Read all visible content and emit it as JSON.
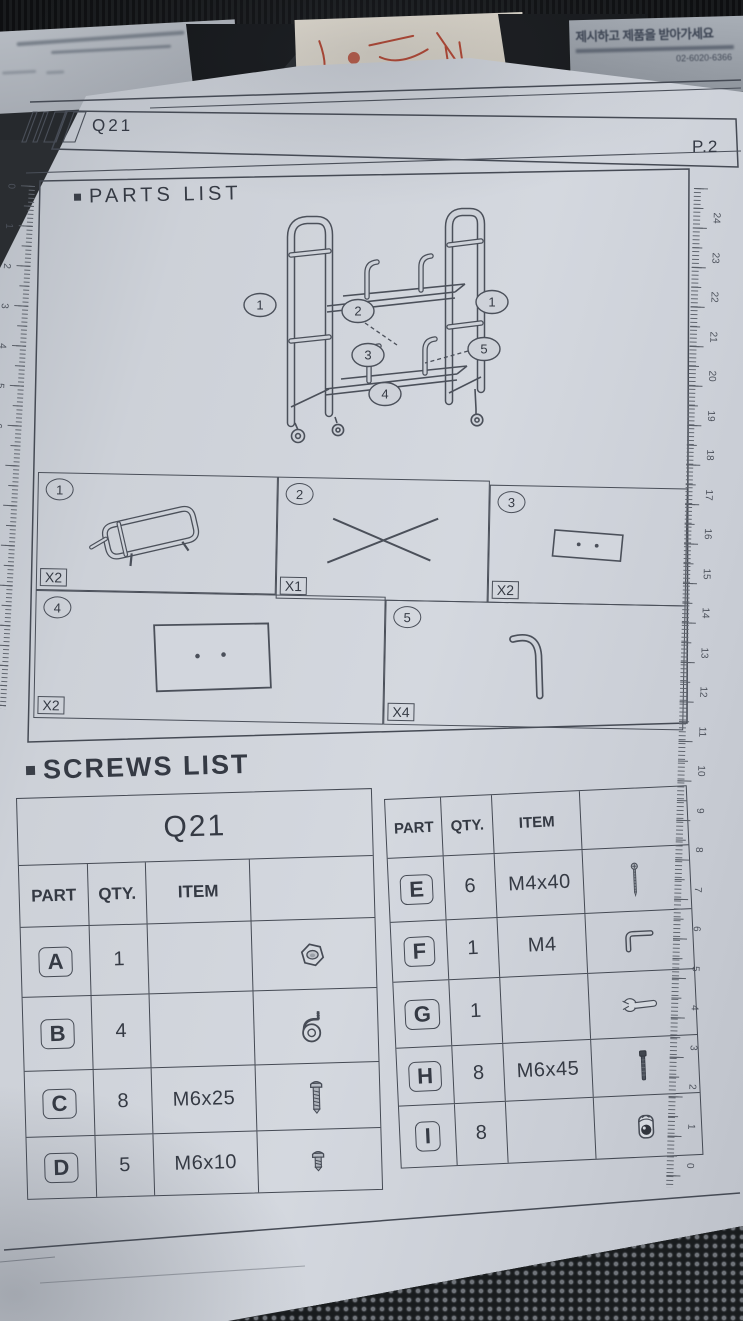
{
  "background": {
    "receipt_korean_line": "제시하고 제품을 받아가세요",
    "receipt_phone": "02-6020-6366"
  },
  "header": {
    "model": "Q21",
    "page": "P.2"
  },
  "parts_section": {
    "title": "PARTS LIST",
    "diagram_callouts": [
      "1",
      "2",
      "1",
      "3",
      "5",
      "4"
    ],
    "grid": [
      {
        "num": "1",
        "qty": "X2",
        "icon": "part-frame"
      },
      {
        "num": "2",
        "qty": "X1",
        "icon": "part-cross"
      },
      {
        "num": "3",
        "qty": "X2",
        "icon": "part-board-small"
      },
      {
        "num": "4",
        "qty": "X2",
        "icon": "part-board"
      },
      {
        "num": "5",
        "qty": "X4",
        "icon": "part-hook"
      }
    ]
  },
  "screws_section": {
    "title": "SCREWS LIST",
    "left_table": {
      "title": "Q21",
      "columns": [
        "PART",
        "QTY.",
        "ITEM",
        ""
      ],
      "rows": [
        {
          "part": "A",
          "qty": "1",
          "item": "",
          "icon": "hex-nut"
        },
        {
          "part": "B",
          "qty": "4",
          "item": "",
          "icon": "caster"
        },
        {
          "part": "C",
          "qty": "8",
          "item": "M6x25",
          "icon": "screw-long"
        },
        {
          "part": "D",
          "qty": "5",
          "item": "M6x10",
          "icon": "screw-short"
        }
      ]
    },
    "right_table": {
      "columns": [
        "PART",
        "QTY.",
        "ITEM",
        ""
      ],
      "rows": [
        {
          "part": "E",
          "qty": "6",
          "item": "M4x40",
          "icon": "screw-thin"
        },
        {
          "part": "F",
          "qty": "1",
          "item": "M4",
          "icon": "allen-key"
        },
        {
          "part": "G",
          "qty": "1",
          "item": "",
          "icon": "wrench"
        },
        {
          "part": "H",
          "qty": "8",
          "item": "M6x45",
          "icon": "bolt-dark"
        },
        {
          "part": "I",
          "qty": "8",
          "item": "",
          "icon": "barrel-nut"
        }
      ]
    }
  },
  "rulers": {
    "right_numbers": [
      24,
      23,
      22,
      21,
      20,
      19,
      18,
      17,
      16,
      15,
      14,
      13,
      12,
      11,
      10,
      9,
      8,
      7,
      6,
      5,
      4,
      3,
      2,
      1,
      0
    ],
    "left_numbers": [
      0,
      1,
      2,
      3,
      4,
      5,
      6,
      7,
      8,
      9,
      10,
      11,
      12
    ]
  },
  "colors": {
    "paper": "#ced2d9",
    "line": "#454a54",
    "ink": "#353a44",
    "background": "#26292d",
    "sketch_red": "#b5442f"
  }
}
